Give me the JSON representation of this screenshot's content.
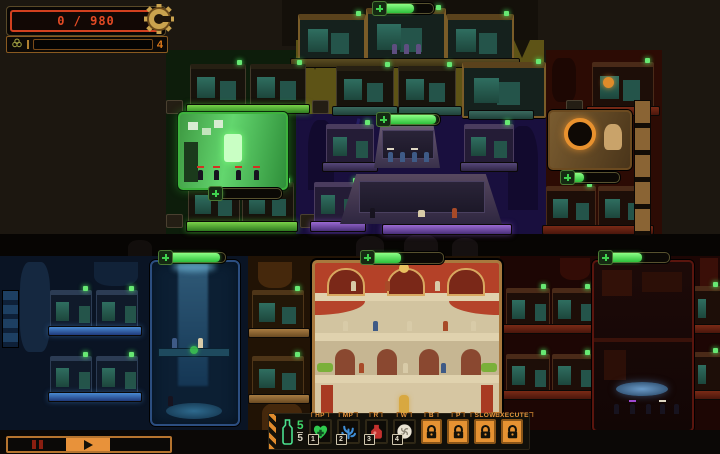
{
  "hud": {
    "progress_counter": "0 / 980",
    "gear_icon": "gear",
    "hazard_row": {
      "biohazard_icon": "biohazard",
      "count": "4"
    }
  },
  "rooms": {
    "command_room": {
      "hp": 65
    },
    "lab_room": {
      "hp": 12
    },
    "ship_room": {
      "hp": 95
    },
    "portal_room": {
      "hp": 33
    },
    "waterfall_room": {
      "hp": 92
    },
    "palace_room": {
      "hp": 45
    },
    "forge_room": {
      "hp": 58
    }
  },
  "toolbar": {
    "ammo": {
      "icon": "ampoule",
      "current": "5",
      "max": "5"
    },
    "slots": [
      {
        "label": "HP",
        "hotkey": "1",
        "icon": "heart-cross-icon",
        "locked": false
      },
      {
        "label": "MP",
        "hotkey": "2",
        "icon": "coral-icon",
        "locked": false
      },
      {
        "label": "R",
        "hotkey": "3",
        "icon": "flask-icon",
        "locked": false
      },
      {
        "label": "W",
        "hotkey": "4",
        "icon": "swirl-icon",
        "locked": false
      },
      {
        "label": "B",
        "icon": "padlock-icon",
        "locked": true
      },
      {
        "label": "P",
        "icon": "padlock-icon",
        "locked": true
      },
      {
        "label": "Slow",
        "icon": "padlock-icon",
        "locked": true
      },
      {
        "label": "Execute",
        "icon": "padlock-icon",
        "locked": true
      }
    ]
  },
  "speed_controls": {
    "pause_icon": "pause",
    "play_icon": "play"
  },
  "colors": {
    "accent_orange": "#e08b2d",
    "hp_green": "#3ecb46",
    "alert_red": "#d2401f"
  }
}
